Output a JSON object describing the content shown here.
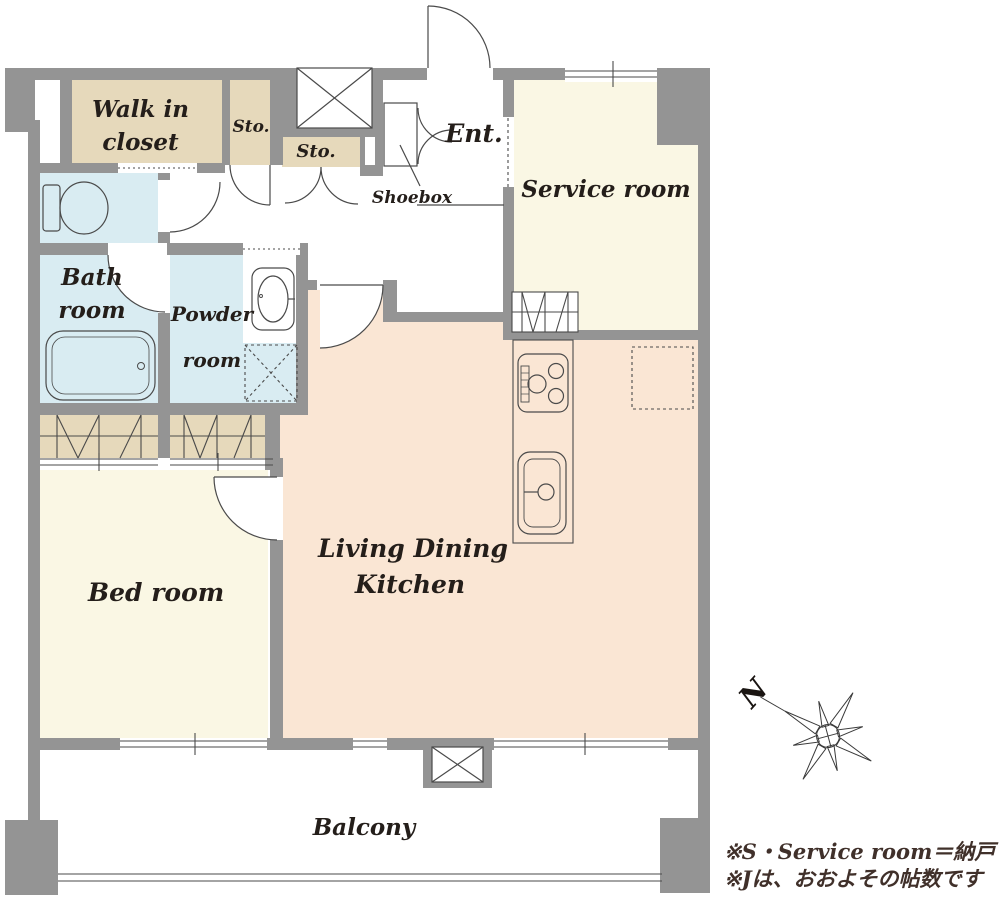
{
  "floorplan": {
    "rooms": {
      "walk_in_closet": {
        "line1": "Walk in",
        "line2": "closet"
      },
      "storage_upper": {
        "label": "Sto."
      },
      "storage_lower": {
        "label": "Sto."
      },
      "entrance": {
        "label": "Ent."
      },
      "shoebox": {
        "label": "Shoebox"
      },
      "service_room": {
        "label": "Service room"
      },
      "bath_room": {
        "line1": "Bath",
        "line2": "room"
      },
      "powder_room": {
        "line1": "Powder",
        "line2": "room"
      },
      "bed_room": {
        "label": "Bed room"
      },
      "living_dining_kitchen": {
        "line1": "Living Dining",
        "line2": "Kitchen"
      },
      "balcony": {
        "label": "Balcony"
      }
    },
    "compass": {
      "north_label": "N"
    },
    "notes": {
      "line1": "※S・Service room＝納戸",
      "line2": "※Jは、おおよその帖数です"
    },
    "icons": {
      "toilet": "toilet-icon",
      "bathtub": "bathtub-icon",
      "washbasin": "washbasin-icon",
      "washing_machine_pan": "washing-machine-pan-icon",
      "stove": "stove-icon",
      "kitchen_sink": "kitchen-sink-icon",
      "refrigerator_space": "refrigerator-space-icon",
      "shaft": "shaft-x-icon",
      "balcony_hatch": "balcony-hatch-icon",
      "compass_rose": "compass-rose-icon"
    },
    "colors": {
      "wall": "#949494",
      "closet_fill": "#e6d9bb",
      "wet_area_fill": "#d9ecf2",
      "room_fill": "#faf7e4",
      "ldk_fill": "#fae6d4",
      "line": "#4a4a4a",
      "label_text": "#241e1a",
      "note_text": "#40302a"
    }
  }
}
